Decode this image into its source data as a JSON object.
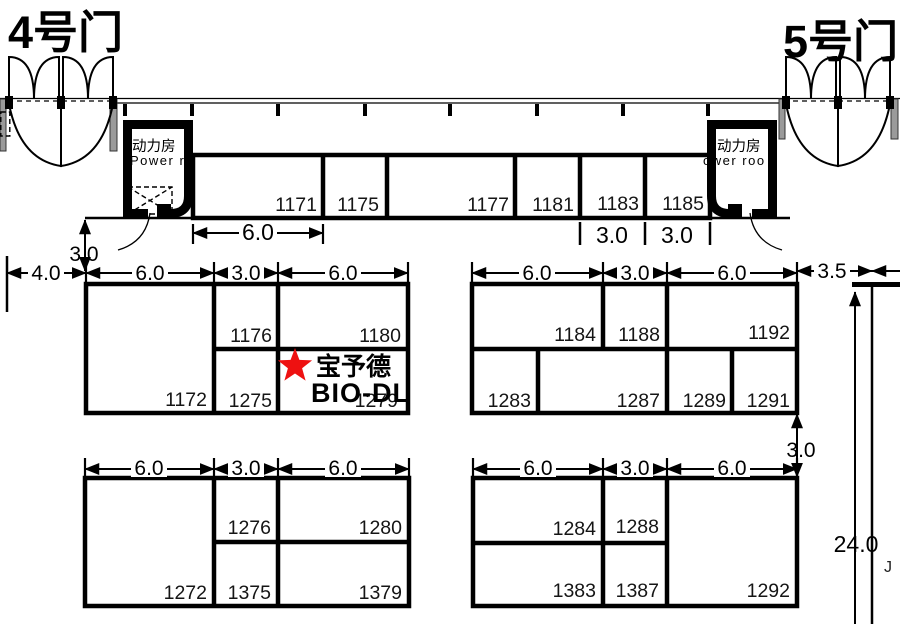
{
  "gates": {
    "gate4": "4号门",
    "gate5": "5号门"
  },
  "power_room": {
    "title_cn": "动力房",
    "subtitle_left": "Power ro",
    "subtitle_right": "ower roo"
  },
  "exhibitor": {
    "name_cn": "宝予德",
    "name_en": "BIO-DL",
    "marker_color": "#ee1111"
  },
  "booths": {
    "b1171": "1171",
    "b1175": "1175",
    "b1177": "1177",
    "b1181": "1181",
    "b1183": "1183",
    "b1185": "1185",
    "b1172": "1172",
    "b1176": "1176",
    "b1180": "1180",
    "b1275": "1275",
    "b1279": "1279",
    "b1184": "1184",
    "b1188": "1188",
    "b1192": "1192",
    "b1283": "1283",
    "b1287": "1287",
    "b1289": "1289",
    "b1291": "1291",
    "b1272": "1272",
    "b1276": "1276",
    "b1280": "1280",
    "b1375": "1375",
    "b1379": "1379",
    "b1284": "1284",
    "b1288": "1288",
    "b1292": "1292",
    "b1383": "1383",
    "b1387": "1387"
  },
  "dims": {
    "top_6": "6.0",
    "top_3a": "3.0",
    "top_3b": "3.0",
    "left_v3": "3.0",
    "left_4": "4.0",
    "ml_6a": "6.0",
    "ml_3": "3.0",
    "ml_6b": "6.0",
    "mr_6a": "6.0",
    "mr_3": "3.0",
    "mr_6b": "6.0",
    "right_35": "3.5",
    "right_v3": "3.0",
    "v24": "24.0",
    "bl_6a": "6.0",
    "bl_3": "3.0",
    "bl_6b": "6.0",
    "br_6a": "6.0",
    "br_3": "3.0",
    "br_6b": "6.0"
  },
  "edge_mark": "J"
}
